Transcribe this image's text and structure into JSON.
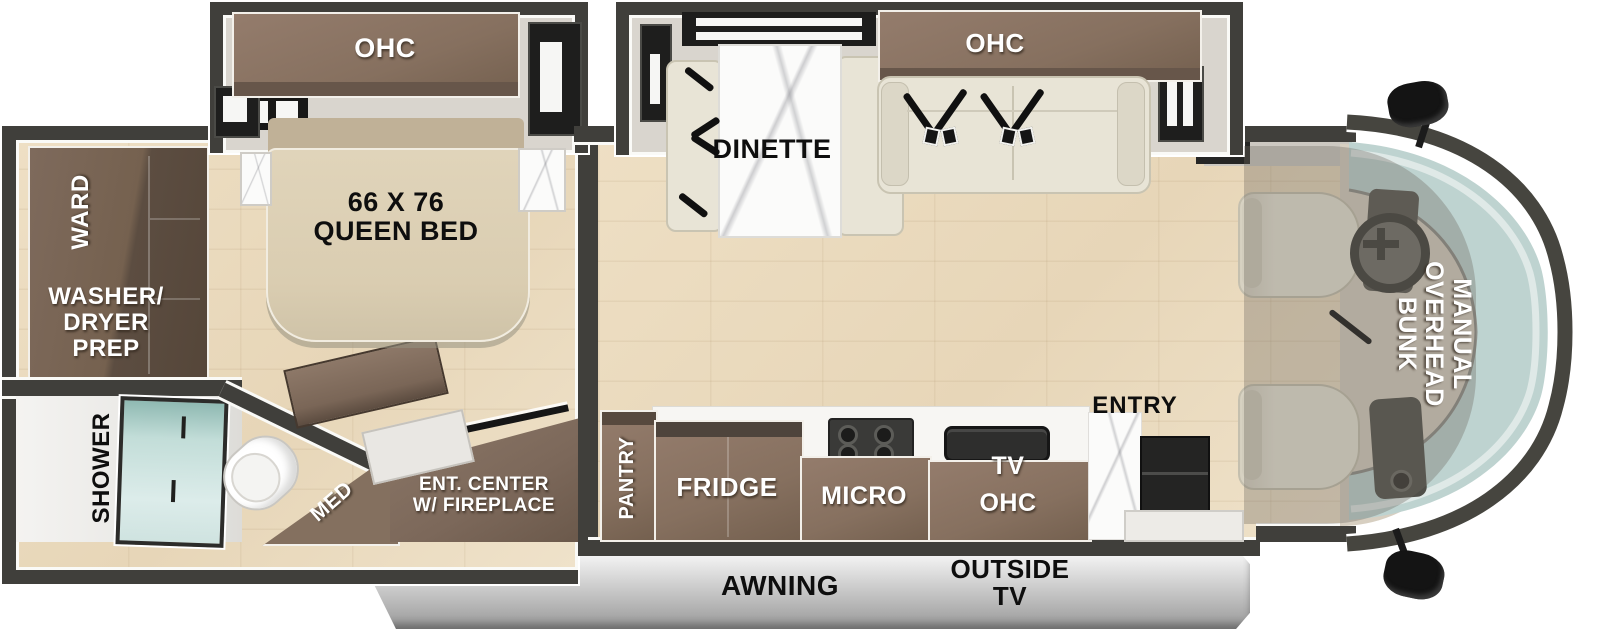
{
  "title": "Class C motorhome floor plan",
  "colors": {
    "wall": "#403f3b",
    "floor_wood": "#ead9bc",
    "cabinet_brown": "#86705f",
    "windshield_glass": "#bed3d0",
    "awning_gray": "#b9b9b9",
    "upholstery": "#e8e4d6"
  },
  "bedroom": {
    "ohc": "OHC",
    "bed_line1": "66 X 76",
    "bed_line2": "QUEEN BED",
    "ward": "WARD",
    "washer_line1": "WASHER/",
    "washer_line2": "DRYER",
    "washer_line3": "PREP",
    "shower": "SHOWER",
    "med": "MED",
    "ent_line1": "ENT. CENTER",
    "ent_line2": "W/ FIREPLACE"
  },
  "living": {
    "dinette": "DINETTE",
    "sofa_ohc": "OHC"
  },
  "kitchen": {
    "pantry": "PANTRY",
    "fridge": "FRIDGE",
    "micro": "MICRO",
    "tv": "TV",
    "tv_ohc": "OHC",
    "entry": "ENTRY"
  },
  "cab": {
    "bunk_line1": "MANUAL",
    "bunk_line2": "OVERHEAD",
    "bunk_line3": "BUNK"
  },
  "exterior": {
    "awning": "AWNING",
    "outside_tv_line1": "OUTSIDE",
    "outside_tv_line2": "TV"
  }
}
